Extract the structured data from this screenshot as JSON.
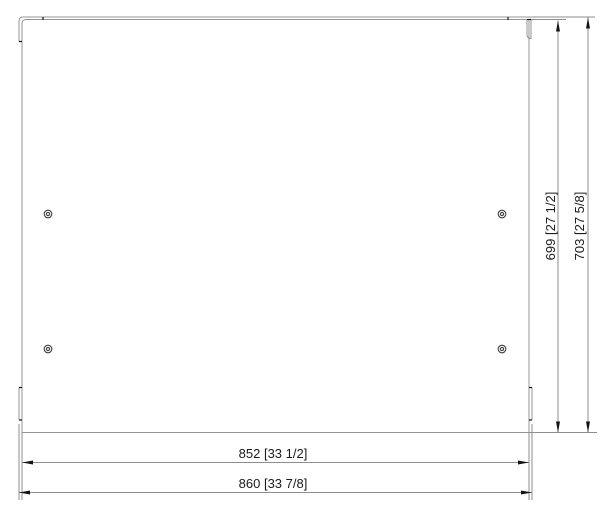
{
  "drawing": {
    "description": "Technical dimension drawing of a rectangular sheet-metal panel with corner flange tabs and four screw holes",
    "colors": {
      "background": "#ffffff",
      "outline": "#949494",
      "dimension_line": "#8e8e8e",
      "arrow": "#141414",
      "text": "#1a1a1a",
      "hole": "#3f3f3f"
    },
    "holes": {
      "count": 4
    },
    "dimensions": {
      "height_inner": {
        "label": "699 [27 1/2]",
        "mm": 699,
        "inches": "27 1/2"
      },
      "height_outer": {
        "label": "703 [27 5/8]",
        "mm": 703,
        "inches": "27 5/8"
      },
      "width_inner": {
        "label": "852 [33 1/2]",
        "mm": 852,
        "inches": "33 1/2"
      },
      "width_outer": {
        "label": "860 [33 7/8]",
        "mm": 860,
        "inches": "33 7/8"
      }
    }
  }
}
